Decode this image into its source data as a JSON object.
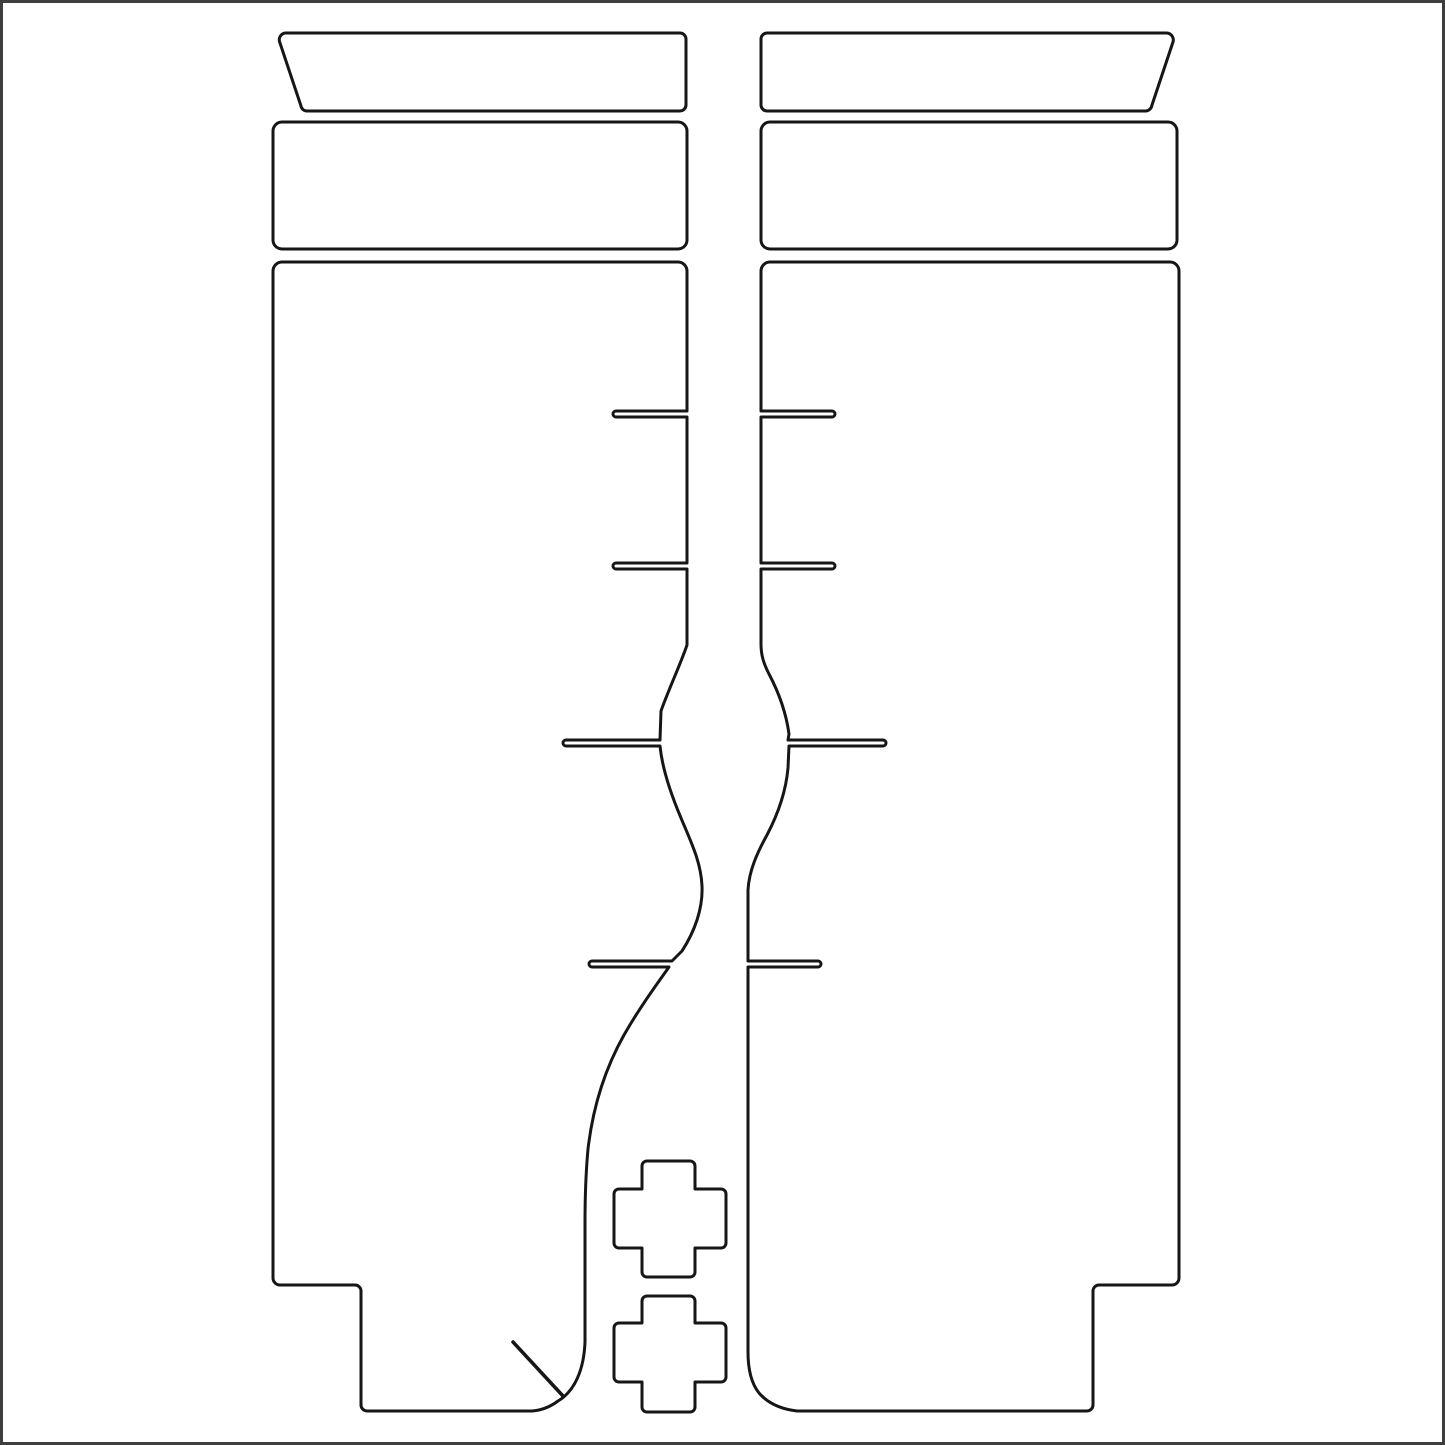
{
  "canvas": {
    "width": 1445,
    "height": 1445,
    "background_color": "#ffffff",
    "line_color": "#161616",
    "fill_color": "#ffffff",
    "line_width": 3,
    "frame_color": "#3e3e3e",
    "frame_width": 3
  },
  "sheet": {
    "description": "die-cut protective film template sheet with two mirrored fork-leg panels, top cap pieces, upper bands, relief-cut slits, two cross patches and a diagonal cut mark",
    "shapes": [
      {
        "name": "top-cap-left-outline",
        "kind": "outline",
        "stroke_width": 3,
        "filled": true,
        "path": "M 680 33 A 6 6 0 0 1 686 39 L 686 105 A 6 6 0 0 1 680 111 L 307 111 A 6 6 0 0 1 301 106 L 280 43 A 7 7 0 0 1 285 33 L 680 33 Z"
      },
      {
        "name": "top-cap-right-outline",
        "kind": "outline",
        "stroke_width": 3,
        "filled": true,
        "path": "M 1167 33 A 7 7 0 0 1 1173 42 L 1152 105 A 7 7 0 0 1 1146 111 L 767 111 A 6 6 0 0 1 761 105 L 761 39 A 6 6 0 0 1 767 33 L 1167 33 Z"
      },
      {
        "name": "upper-band-left-outline",
        "kind": "outline",
        "stroke_width": 3,
        "filled": true,
        "path": "M 282 122 L 678 122 A 9 9 0 0 1 687 131 L 687 240 A 9 9 0 0 1 678 249 L 282 249 A 9 9 0 0 1 273 240 L 273 131 A 9 9 0 0 1 282 122 Z"
      },
      {
        "name": "upper-band-right-outline",
        "kind": "outline",
        "stroke_width": 3,
        "filled": true,
        "path": "M 770 122 L 1168 122 A 9 9 0 0 1 1177 131 L 1177 240 A 9 9 0 0 1 1168 249 L 770 249 A 9 9 0 0 1 761 240 L 761 131 A 9 9 0 0 1 770 122 Z"
      },
      {
        "name": "main-panel-left-outline",
        "kind": "outline",
        "stroke_width": 3,
        "filled": true,
        "path": "M 282 262 L 678 262 A 9 9 0 0 1 687 271 L 687 411 L 616 411 A 3 3 0 0 0 616 417 L 687 417 L 687 563 L 616 563 A 3 3 0 0 0 616 569 L 687 569 L 687 645 C 681 663 668 691 661 711 L 660 740 L 566 740 A 3 3 0 0 0 566 746 L 660 746 C 662 766 670 792 681 818 C 691 842 701 862 702 886 C 703 908 695 931 682 951 L 672 961 L 592 961 A 3 3 0 0 0 592 967 L 669 967 C 657 984 640 1007 624 1035 C 606 1067 593 1106 588 1149 C 586 1171 585 1193 585 1223 L 585 1342 C 584 1369 575 1391 558 1401 Q 546 1410 532 1411 L 367 1411 A 6 6 0 0 1 361 1405 L 361 1291 A 6 6 0 0 0 355 1285 L 280 1285 A 7 7 0 0 1 273 1278 L 273 271 A 9 9 0 0 1 282 262 Z"
      },
      {
        "name": "main-panel-right-outline",
        "kind": "outline",
        "stroke_width": 3,
        "filled": true,
        "path": "M 770 262 L 1170 262 A 9 9 0 0 1 1179 271 L 1179 1278 A 7 7 0 0 1 1172 1285 L 1099 1285 A 6 6 0 0 0 1093 1291 L 1093 1405 A 6 6 0 0 1 1087 1411 L 797 1411 Q 772 1408 759 1393 C 751 1383 748 1368 748 1352 L 748 967 L 818 967 A 3 3 0 0 0 818 961 L 748 961 L 748 890 C 749 871 757 853 767 835 C 778 814 786 791 788 768 L 789 746 L 883 746 A 3 3 0 0 0 883 740 L 788 740 L 789 734 C 786 712 778 691 769 674 C 764 664 761 656 761 644 L 761 569 L 832 569 A 3 3 0 0 0 832 563 L 761 563 L 761 417 L 832 417 A 3 3 0 0 0 832 411 L 761 411 L 761 271 A 9 9 0 0 1 770 262 Z"
      },
      {
        "name": "cross-patch-upper-outline",
        "kind": "outline",
        "stroke_width": 3,
        "filled": true,
        "path": "M 647 1161 L 690 1161 A 5 5 0 0 1 695 1166 L 695 1189 L 721 1189 A 5 5 0 0 1 726 1194 L 726 1243 A 5 5 0 0 1 721 1248 L 695 1248 L 695 1272 A 5 5 0 0 1 690 1277 L 647 1277 A 5 5 0 0 1 642 1272 L 642 1248 L 619 1248 A 5 5 0 0 1 614 1243 L 614 1194 A 5 5 0 0 1 619 1189 L 642 1189 L 642 1166 A 5 5 0 0 1 647 1161 Z"
      },
      {
        "name": "cross-patch-lower-outline",
        "kind": "outline",
        "stroke_width": 3,
        "filled": true,
        "path": "M 647 1296 L 690 1296 A 5 5 0 0 1 695 1301 L 695 1323 L 721 1323 A 5 5 0 0 1 726 1328 L 726 1377 A 5 5 0 0 1 721 1382 L 695 1382 L 695 1407 A 5 5 0 0 1 690 1412 L 647 1412 A 5 5 0 0 1 642 1407 L 642 1382 L 619 1382 A 5 5 0 0 1 614 1377 L 614 1328 A 5 5 0 0 1 619 1323 L 642 1323 L 642 1301 A 5 5 0 0 1 647 1296 Z"
      },
      {
        "name": "diagonal-cut-mark",
        "kind": "mark",
        "stroke_width": 3.5,
        "filled": false,
        "path": "M 513 1342 L 563 1396"
      }
    ]
  }
}
